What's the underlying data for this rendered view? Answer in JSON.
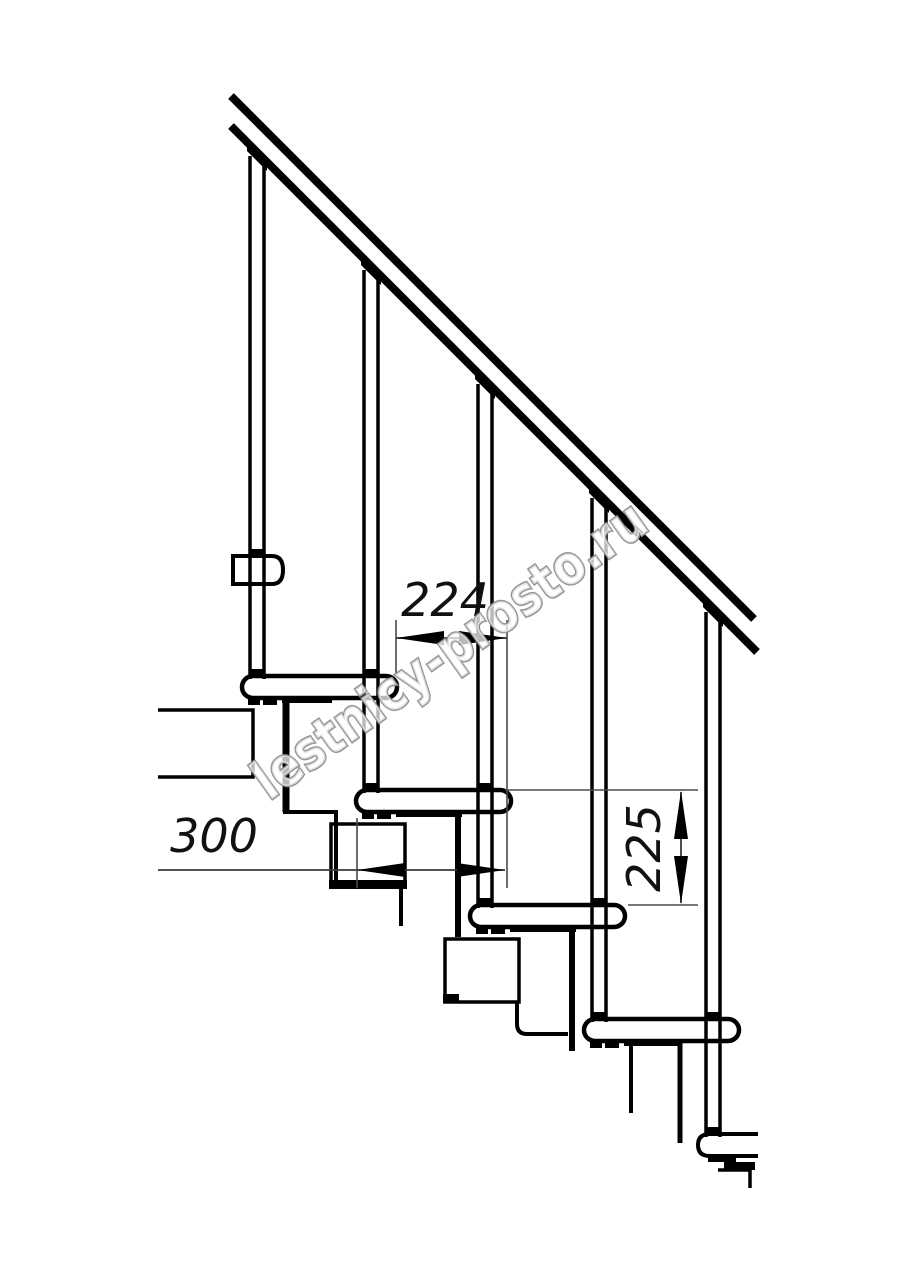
{
  "title": "Modular staircase side-view technical drawing",
  "watermark": {
    "text": "lestnicy-prosto.ru"
  },
  "dimensions": {
    "going_mm": {
      "label": "224"
    },
    "tread_depth_mm": {
      "label": "300"
    },
    "rise_mm": {
      "label": "225"
    }
  },
  "components": {
    "handrail_count": 1,
    "baluster_count": 5,
    "tread_count": 5
  },
  "colors": {
    "line": "#000000",
    "dimension_line": "#3a3a3a",
    "watermark_stroke": "#8f8f8f",
    "background": "#ffffff"
  }
}
